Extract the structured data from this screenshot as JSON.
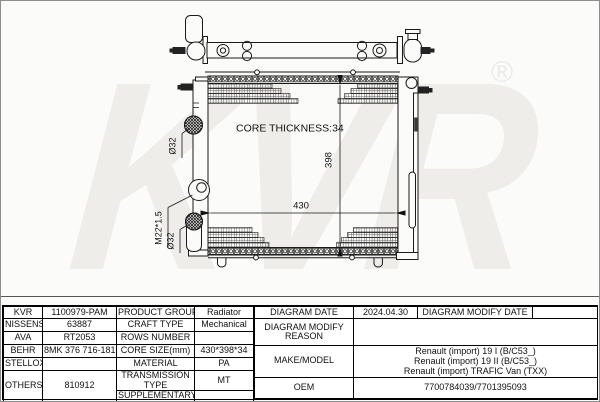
{
  "watermark": {
    "brand": "KVR",
    "registered": "®"
  },
  "diagram": {
    "core_thickness": "CORE THICKNESS:34",
    "width_dim": "430",
    "height_dim": "398",
    "inlet_diameter": "Ø32",
    "drain_thread": "M22*1.5",
    "outlet_diameter": "Ø32"
  },
  "table": {
    "left": {
      "rows": [
        {
          "brand": "KVR",
          "number": "1100979-PAM",
          "property": "PRODUCT GROUP",
          "value": "Radiator"
        },
        {
          "brand": "NISSENS",
          "number": "63887",
          "property": "CRAFT TYPE",
          "value": "Mechanical"
        },
        {
          "brand": "AVA",
          "number": "RT2053",
          "property": "ROWS NUMBER",
          "value": ""
        },
        {
          "brand": "BEHR",
          "number": "8MK 376 716-181",
          "property": "CORE SIZE(mm)",
          "value": "430*398*34"
        },
        {
          "brand": "STELLOX",
          "number": "",
          "property": "MATERIAL",
          "value": "PA"
        },
        {
          "brand": "OTHERS",
          "number": "810912",
          "property": "TRANSMISSION TYPE",
          "value": "MT"
        },
        {
          "brand": "",
          "number": "",
          "property": "SUPPLEMENTARY",
          "value": ""
        }
      ]
    },
    "right": {
      "diagram_date_label": "DIAGRAM DATE",
      "diagram_date": "2024.04.30",
      "modify_date_label": "DIAGRAM MODIFY DATE",
      "modify_date": "",
      "modify_reason_label": "DIAGRAM MODIFY REASON",
      "modify_reason": "",
      "make_model_label": "MAKE/MODEL",
      "make_model": [
        "Renault (import) 19 I (B/C53_)",
        "Renault (import) 19 II (B/C53_)",
        "Renault (import) TRAFIC Van (TXX)"
      ],
      "oem_label": "OEM",
      "oem": "7700784039/7701395093"
    }
  }
}
